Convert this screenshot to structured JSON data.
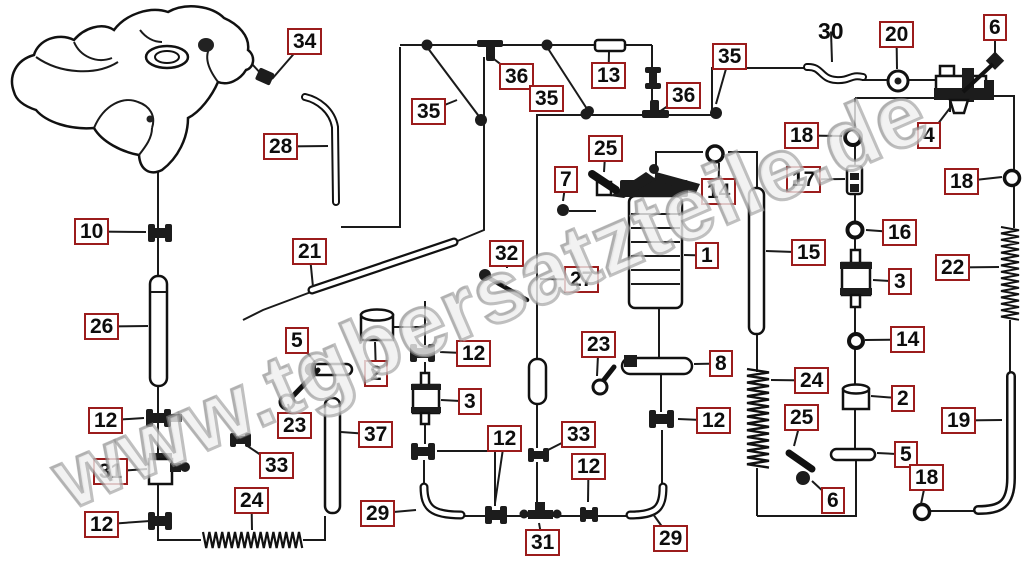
{
  "watermark": {
    "text": "www.tgbersatzteile.de"
  },
  "colors": {
    "label_border": "#9b1c1c",
    "label_text": "#0d0d0d",
    "line": "#1a1a1a",
    "watermark_gray": "#8c8c8c"
  },
  "labels": [
    {
      "num": "34",
      "x": 287,
      "y": 28,
      "boxed": true,
      "leader": [
        272,
        79
      ]
    },
    {
      "num": "28",
      "x": 263,
      "y": 133,
      "boxed": true,
      "leader": [
        328,
        146
      ]
    },
    {
      "num": "10",
      "x": 74,
      "y": 218,
      "boxed": true,
      "leader": [
        146,
        232
      ]
    },
    {
      "num": "26",
      "x": 84,
      "y": 313,
      "boxed": true,
      "leader": [
        148,
        326
      ]
    },
    {
      "num": "12",
      "x": 88,
      "y": 407,
      "boxed": true,
      "leader": [
        144,
        418
      ]
    },
    {
      "num": "31",
      "x": 93,
      "y": 458,
      "boxed": true,
      "leader": [
        147,
        469
      ]
    },
    {
      "num": "12",
      "x": 84,
      "y": 511,
      "boxed": true,
      "leader": [
        150,
        521
      ]
    },
    {
      "num": "24",
      "x": 234,
      "y": 487,
      "boxed": true,
      "leader": [
        252,
        530
      ]
    },
    {
      "num": "33",
      "x": 259,
      "y": 452,
      "boxed": true,
      "leader": [
        246,
        445
      ]
    },
    {
      "num": "23",
      "x": 277,
      "y": 412,
      "boxed": true,
      "leader": [
        288,
        404
      ]
    },
    {
      "num": "21",
      "x": 292,
      "y": 238,
      "boxed": true,
      "leader": [
        313,
        287
      ]
    },
    {
      "num": "5",
      "x": 285,
      "y": 327,
      "boxed": true,
      "leader": [
        315,
        362
      ]
    },
    {
      "num": "2",
      "x": 364,
      "y": 360,
      "boxed": true,
      "leader": [
        375,
        342
      ]
    },
    {
      "num": "37",
      "x": 358,
      "y": 421,
      "boxed": true,
      "leader": [
        341,
        432
      ]
    },
    {
      "num": "12",
      "x": 456,
      "y": 340,
      "boxed": true,
      "leader": [
        440,
        352
      ]
    },
    {
      "num": "3",
      "x": 458,
      "y": 388,
      "boxed": true,
      "leader": [
        441,
        400
      ]
    },
    {
      "num": "12",
      "x": 487,
      "y": 425,
      "boxed": true,
      "leader": [
        495,
        503
      ]
    },
    {
      "num": "29",
      "x": 360,
      "y": 500,
      "boxed": true,
      "leader": [
        416,
        510
      ]
    },
    {
      "num": "31",
      "x": 525,
      "y": 529,
      "boxed": true,
      "leader": [
        539,
        523
      ]
    },
    {
      "num": "33",
      "x": 561,
      "y": 421,
      "boxed": true,
      "leader": [
        548,
        450
      ]
    },
    {
      "num": "12",
      "x": 571,
      "y": 453,
      "boxed": true,
      "leader": [
        588,
        502
      ]
    },
    {
      "num": "29",
      "x": 653,
      "y": 525,
      "boxed": true,
      "leader": [
        653,
        514
      ]
    },
    {
      "num": "32",
      "x": 489,
      "y": 240,
      "boxed": true,
      "leader": [
        507,
        268
      ]
    },
    {
      "num": "27",
      "x": 564,
      "y": 266,
      "boxed": true,
      "leader": [
        540,
        279
      ]
    },
    {
      "num": "25",
      "x": 588,
      "y": 135,
      "boxed": true,
      "leader": [
        604,
        172
      ]
    },
    {
      "num": "7",
      "x": 554,
      "y": 166,
      "boxed": true,
      "leader": [
        563,
        201
      ]
    },
    {
      "num": "23",
      "x": 581,
      "y": 331,
      "boxed": true,
      "leader": [
        597,
        376
      ]
    },
    {
      "num": "8",
      "x": 709,
      "y": 350,
      "boxed": true,
      "leader": [
        694,
        364
      ]
    },
    {
      "num": "1",
      "x": 695,
      "y": 242,
      "boxed": true,
      "leader": [
        684,
        255
      ]
    },
    {
      "num": "14",
      "x": 701,
      "y": 178,
      "boxed": true,
      "leader": [
        719,
        163
      ]
    },
    {
      "num": "12",
      "x": 696,
      "y": 407,
      "boxed": true,
      "leader": [
        678,
        419
      ]
    },
    {
      "num": "35",
      "x": 411,
      "y": 98,
      "boxed": true,
      "leader": [
        457,
        100
      ]
    },
    {
      "num": "36",
      "x": 499,
      "y": 63,
      "boxed": true,
      "leader": [
        490,
        56
      ]
    },
    {
      "num": "35",
      "x": 529,
      "y": 85,
      "boxed": true
    },
    {
      "num": "13",
      "x": 591,
      "y": 62,
      "boxed": true,
      "leader": [
        609,
        52
      ]
    },
    {
      "num": "36",
      "x": 666,
      "y": 82,
      "boxed": true,
      "leader": [
        659,
        112
      ]
    },
    {
      "num": "35",
      "x": 712,
      "y": 43,
      "boxed": true,
      "leader": [
        716,
        104
      ]
    },
    {
      "num": "30",
      "x": 814,
      "y": 20,
      "boxed": false,
      "leader": [
        832,
        62
      ]
    },
    {
      "num": "20",
      "x": 879,
      "y": 21,
      "boxed": true,
      "leader": [
        897,
        69
      ]
    },
    {
      "num": "6",
      "x": 983,
      "y": 14,
      "boxed": true,
      "leader": [
        995,
        56
      ]
    },
    {
      "num": "4",
      "x": 917,
      "y": 122,
      "boxed": true,
      "leader": [
        950,
        108
      ]
    },
    {
      "num": "18",
      "x": 784,
      "y": 122,
      "boxed": true,
      "leader": [
        842,
        136
      ]
    },
    {
      "num": "17",
      "x": 786,
      "y": 166,
      "boxed": true,
      "leader": [
        845,
        179
      ]
    },
    {
      "num": "18",
      "x": 944,
      "y": 168,
      "boxed": true,
      "leader": [
        1002,
        177
      ]
    },
    {
      "num": "16",
      "x": 882,
      "y": 219,
      "boxed": true,
      "leader": [
        866,
        230
      ]
    },
    {
      "num": "22",
      "x": 935,
      "y": 254,
      "boxed": true,
      "leader": [
        999,
        267
      ]
    },
    {
      "num": "3",
      "x": 888,
      "y": 268,
      "boxed": true,
      "leader": [
        873,
        280
      ]
    },
    {
      "num": "14",
      "x": 890,
      "y": 326,
      "boxed": true,
      "leader": [
        865,
        340
      ]
    },
    {
      "num": "15",
      "x": 791,
      "y": 239,
      "boxed": true,
      "leader": [
        766,
        251
      ]
    },
    {
      "num": "24",
      "x": 794,
      "y": 367,
      "boxed": true,
      "leader": [
        771,
        380
      ]
    },
    {
      "num": "25",
      "x": 784,
      "y": 404,
      "boxed": true,
      "leader": [
        794,
        446
      ]
    },
    {
      "num": "2",
      "x": 891,
      "y": 385,
      "boxed": true,
      "leader": [
        871,
        396
      ]
    },
    {
      "num": "5",
      "x": 894,
      "y": 441,
      "boxed": true,
      "leader": [
        877,
        453
      ]
    },
    {
      "num": "6",
      "x": 821,
      "y": 487,
      "boxed": true,
      "leader": [
        812,
        481
      ]
    },
    {
      "num": "18",
      "x": 909,
      "y": 464,
      "boxed": true,
      "leader": [
        921,
        504
      ]
    },
    {
      "num": "19",
      "x": 941,
      "y": 407,
      "boxed": true,
      "leader": [
        1002,
        420
      ]
    }
  ]
}
